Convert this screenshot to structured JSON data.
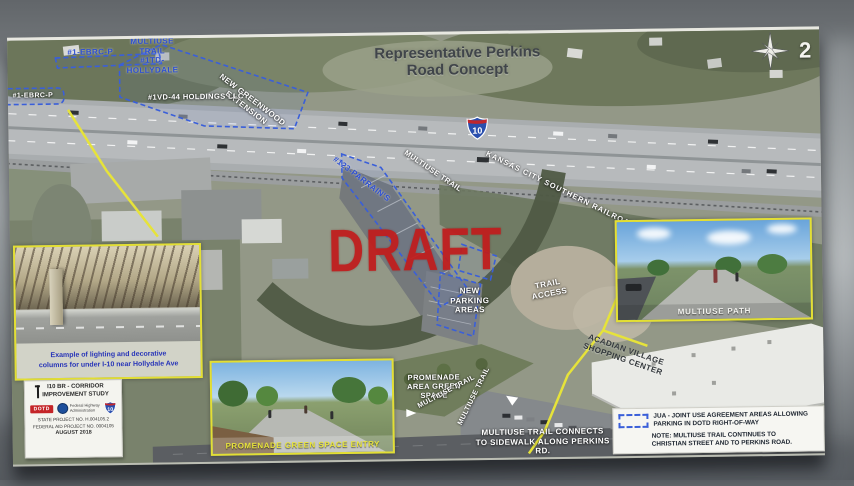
{
  "page_number": "2",
  "title": "Representative Perkins\nRoad Concept",
  "watermark": "DRAFT",
  "shield_number": "10",
  "parcels": {
    "ebrc_top": "#1-EBRC-P",
    "ebrc_left": "#1-EBRC-P",
    "hollydale": "MULTIUSE TRAIL\n#1TD-\nHOLLYDALE",
    "holdings": "#1VD-44 HOLDINGS LLC",
    "parrains": "#123-PARRAIN'S"
  },
  "map_labels": {
    "greenwood": "NEW GREENWOOD EXTENSION",
    "railroad": "KANSAS CITY SOUTHERN RAILROAD",
    "multiuse_trail_upper": "MULTIUSE TRAIL",
    "new_parking": "NEW\nPARKING\nAREAS",
    "trail_access": "TRAIL\nACCESS",
    "acadian_village": "ACADIAN VILLAGE\nSHOPPING CENTER",
    "promenade_green_space": "PROMENADE\nAREA GREEN\nSPACE",
    "multiuse_trail_promenade": "MULTIUSE TRAIL",
    "multiuse_trail_lower": "MULTIUSE TRAIL",
    "trail_connects": "MULTIUSE TRAIL CONNECTS\nTO SIDEWALK ALONG PERKINS RD."
  },
  "insets": {
    "lighting_caption": "Example of lighting and decorative\ncolumns for under I-10 near Hollydale Ave",
    "promenade_caption": "PROMENADE GREEN SPACE ENTRY",
    "multiuse_caption": "MULTIUSE PATH"
  },
  "info_box": {
    "study_title": "I10 BR - CORRIDOR\nIMPROVEMENT STUDY",
    "dotd": "DOTD",
    "fhwa": "Federal Highway\nAdministration",
    "shield": "10",
    "state_project": "STATE PROJECT NO. H.004105.2",
    "federal_project": "FEDERAL AID PROJECT NO. 0004105",
    "date": "AUGUST 2018"
  },
  "legend": {
    "jua_line": "JUA - JOINT USE AGREEMENT AREAS ALLOWING\nPARKING IN DOTD RIGHT-OF-WAY",
    "note_line": "NOTE: MULTIUSE TRAIL CONTINUES TO\nCHRISTIAN STREET AND TO PERKINS ROAD."
  },
  "colors": {
    "draft_red": "#c11c1c",
    "jua_blue": "#3a5fd9",
    "trail_yellow": "#e6e33a",
    "inset_border": "#e3df33"
  }
}
